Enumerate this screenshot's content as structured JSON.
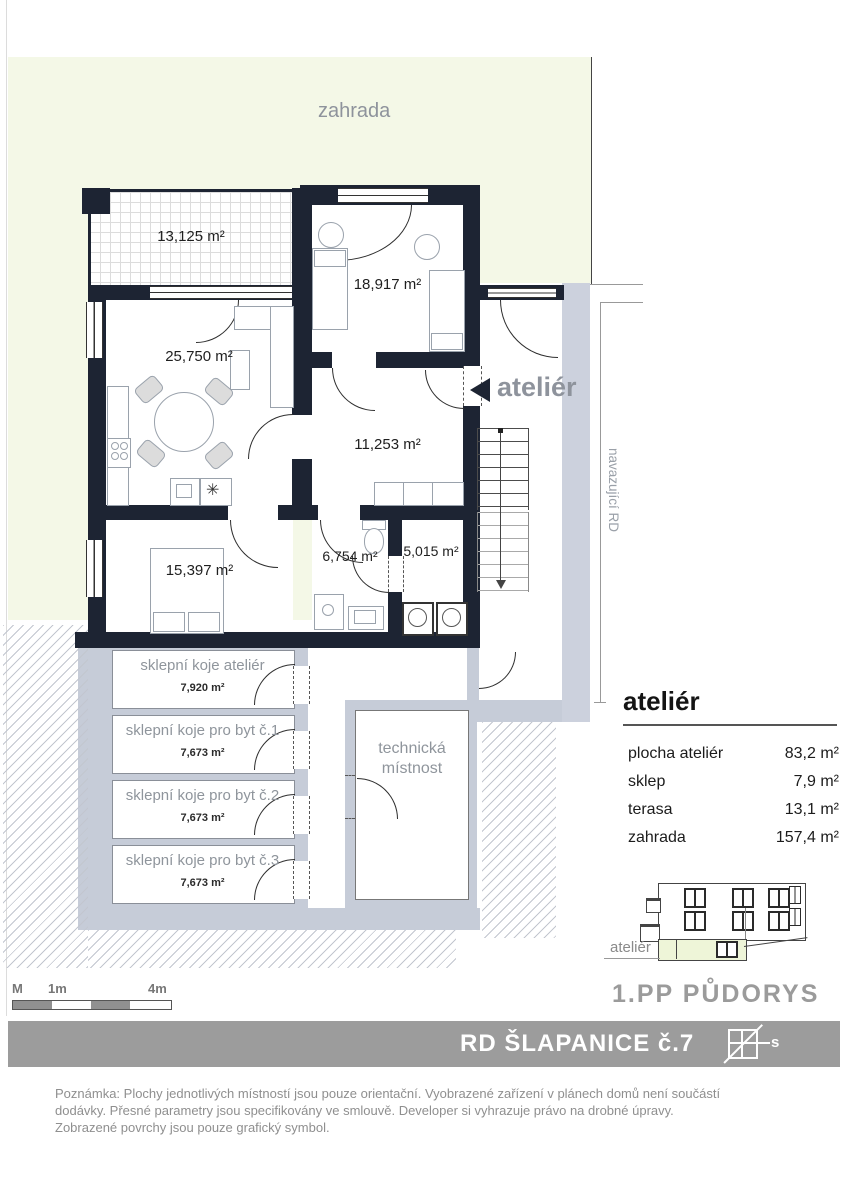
{
  "garden": {
    "label": "zahrada"
  },
  "rooms": {
    "terrace": "13,125 m²",
    "bedroom_upper": "18,917 m²",
    "living": "25,750 m²",
    "hall": "11,253 m²",
    "bedroom_lower": "15,397 m²",
    "bathroom": "6,754 m²",
    "utility": "5,015 m²"
  },
  "plan": {
    "atelier_pointer": "ateliér",
    "adjacent_label": "navazující RD",
    "kitchen_symbol": "✳"
  },
  "basement": {
    "storage_units": [
      {
        "label": "sklepní koje ateliér",
        "area": "7,920 m²"
      },
      {
        "label": "sklepní koje pro byt č.1",
        "area": "7,673 m²"
      },
      {
        "label": "sklepní koje pro byt č.2",
        "area": "7,673 m²"
      },
      {
        "label": "sklepní koje pro byt č.3",
        "area": "7,673 m²"
      }
    ],
    "tech_line1": "technická",
    "tech_line2": "místnost"
  },
  "panel": {
    "title": "ateliér",
    "rows": [
      {
        "label": "plocha ateliér",
        "value": "83,2  m²"
      },
      {
        "label": "sklep",
        "value": "7,9 m²"
      },
      {
        "label": "terasa",
        "value": "13,1  m²"
      },
      {
        "label": "zahrada",
        "value": "157,4 m²"
      }
    ]
  },
  "elevation": {
    "label": "ateliér",
    "caption": "1.PP PŮDORYS"
  },
  "scale": {
    "m": "M",
    "one": "1m",
    "four": "4m"
  },
  "banner": {
    "title": "RD ŠLAPANICE  č.7",
    "compass_letter": "s"
  },
  "footer": {
    "line1": "Poznámka: Plochy jednotlivých místností jsou pouze orientační. Vyobrazené zařízení v plánech domů  není součástí",
    "line2": "dodávky. Přesné parametry jsou specifikovány ve smlouvě. Developer si vyhrazuje právo na drobné úpravy.",
    "line3": "Zobrazené povrchy jsou pouze grafický symbol."
  },
  "colors": {
    "wall": "#1d2433",
    "garden": "#f4f8e7",
    "basement_wall": "#c6ccd8",
    "banner": "#9c9c9c",
    "highlight": "#eef5d8"
  }
}
